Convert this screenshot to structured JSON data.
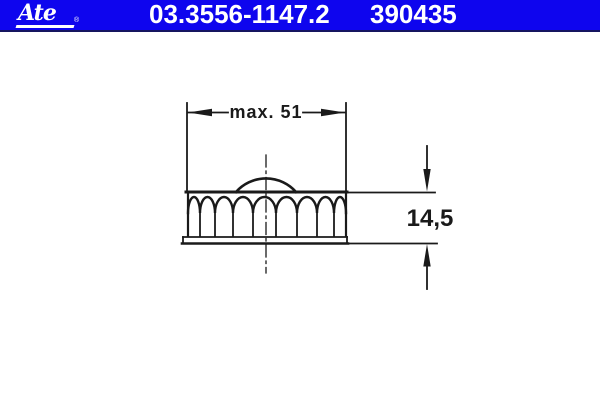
{
  "header": {
    "logo_text": "Ate",
    "logo_reg": "®",
    "part_number": "03.3556-1147.2",
    "reference_number": "390435"
  },
  "drawing": {
    "width_label": "max. 51",
    "height_label": "14,5"
  },
  "colors": {
    "header_bg": "#0e05ee",
    "header_border": "#15155f",
    "header_text": "#ffffff",
    "line": "#1a1a1a",
    "canvas_bg": "#ffffff"
  }
}
